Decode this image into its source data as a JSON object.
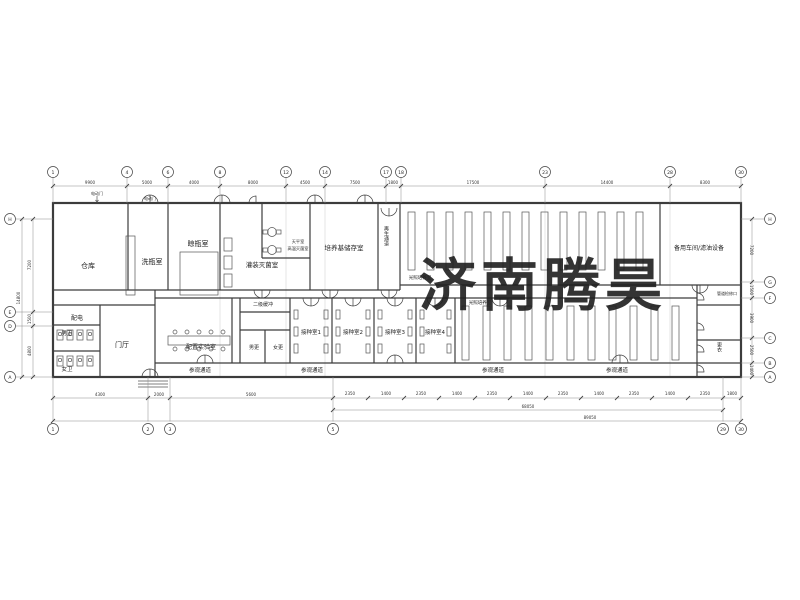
{
  "watermark": {
    "text": "济南腾昊",
    "color": "#ee3b50"
  },
  "rooms": {
    "warehouse": "仓库",
    "bottle_wash": "洗瓶室",
    "bottle_dry": "晾瓶室",
    "fill_sterilize": "灌装灭菌室",
    "medium_storage": "培养基储存室",
    "spare_workshop": "备用车间/滤油设备",
    "power": "配电",
    "men_wc": "男卫",
    "women_wc": "女卫",
    "lobby": "门厅",
    "prep_lab": "配置实验室",
    "men_change": "男更",
    "women_change": "女更",
    "inoc1": "接种室1",
    "inoc2": "接种室2",
    "inoc3": "接种室3",
    "inoc4": "接种室4"
  },
  "labels": {
    "visit_corridor": "参观通道",
    "light_culture": "光照培养室",
    "regen_corridor": "再生通道",
    "changing": "更衣",
    "balance_room": "天平室",
    "autoclave_room": "高温灭菌室",
    "pipe_access": "管道检修口",
    "electric_door": "电动门",
    "buffer2": "二级缓冲"
  },
  "grid": {
    "top": [
      "1",
      "4",
      "6",
      "8",
      "12",
      "14",
      "17",
      "18",
      "23",
      "28",
      "30"
    ],
    "bottom": [
      "1",
      "2",
      "3",
      "5",
      "29",
      "30"
    ],
    "left": [
      "H",
      "E",
      "D",
      "A"
    ],
    "right": [
      "H",
      "G",
      "F",
      "C",
      "B",
      "A"
    ]
  },
  "dims": {
    "top": [
      "9900",
      "5000",
      "4000",
      "8000",
      "4500",
      "7500",
      "1800",
      "17500",
      "14400",
      "8300"
    ],
    "bottom_left": [
      "4300",
      "2000",
      "5600"
    ],
    "chain": [
      "2350",
      "1400",
      "2350",
      "1400",
      "2350",
      "1400",
      "2350",
      "1400",
      "2350",
      "1400",
      "2350"
    ],
    "right_tail": "1800",
    "bottom_overall": "68050",
    "bottom_total": "89050",
    "left": [
      "7200",
      "1500",
      "4800"
    ],
    "left_total": "14800",
    "right": [
      "7200",
      "1500",
      "3900",
      "2500",
      "1400"
    ]
  }
}
